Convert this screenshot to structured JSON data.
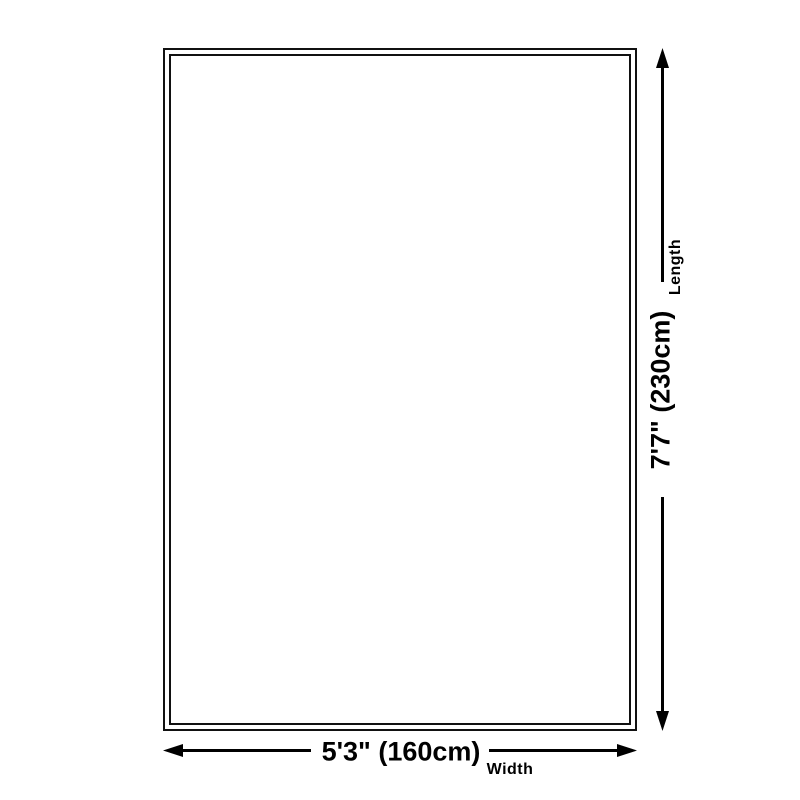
{
  "colors": {
    "background": "#ffffff",
    "outline": "#111111",
    "arrow": "#000000",
    "text": "#000000"
  },
  "length": {
    "value": "7'7\" (230cm)",
    "label": "Length"
  },
  "width": {
    "value": "5'3\" (160cm)",
    "label": "Width"
  }
}
